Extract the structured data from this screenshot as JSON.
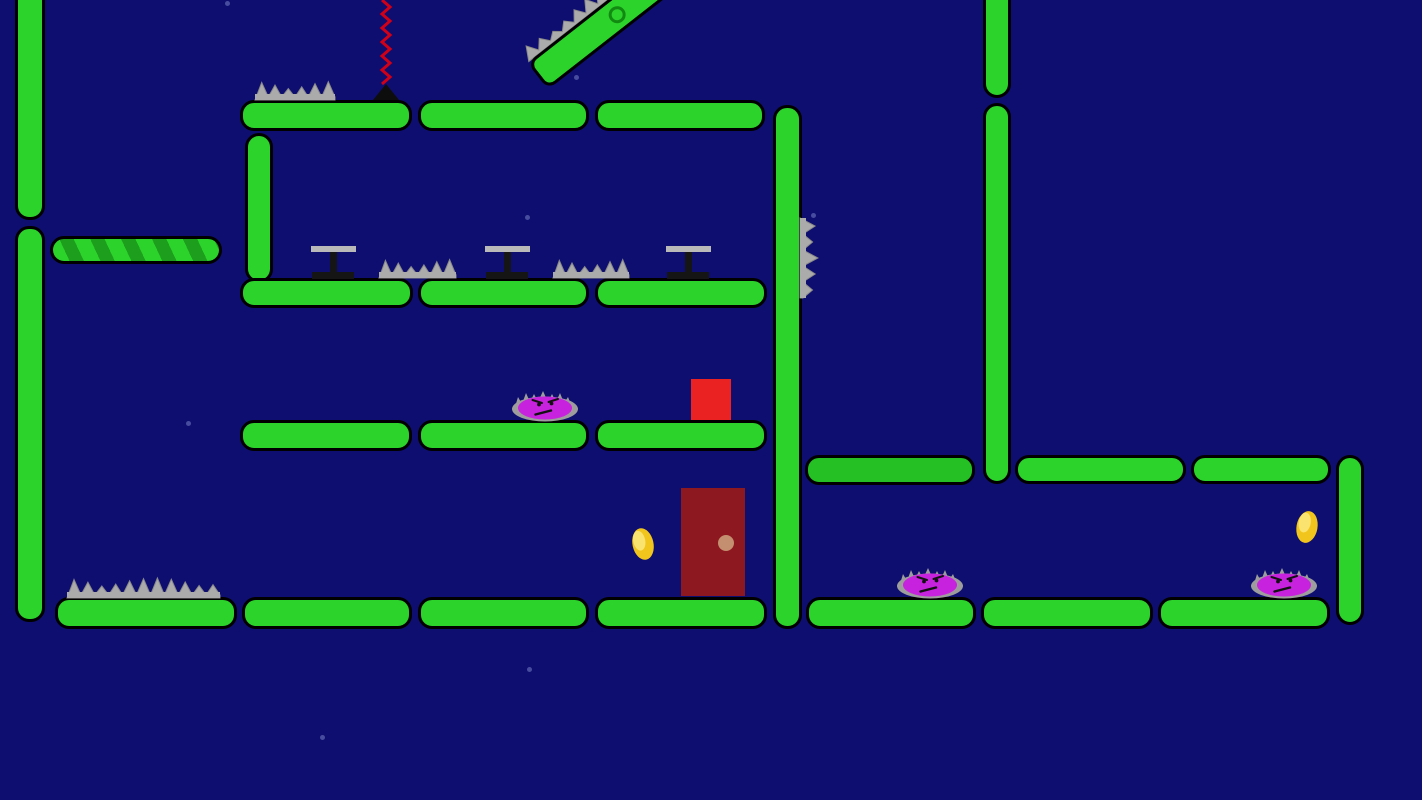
{
  "scene": {
    "width": 1422,
    "height": 800,
    "description": "2D platformer level: night-blue sky, green capsule platforms, gray spikes, purple spiky enemies, gold coins, maroon exit door, red player block, striped and mossy platforms, red zigzag rope, tilted spiked platform with pivot pin"
  },
  "colors": {
    "background": "#0e0e70",
    "platform_green": "#2bd32b",
    "platform_outline": "#000000",
    "stripe_dark": "#1d9e1d",
    "moss_green": "#24c024",
    "spike_gray": "#ababab",
    "spike_edge": "#8a8a8a",
    "table_gray": "#b9b9b9",
    "table_dark": "#151515",
    "enemy_purple": "#c722dd",
    "enemy_aura": "#9d9d9d",
    "enemy_face": "#111111",
    "coin_gold": "#f2c51d",
    "coin_highlight": "#fbe87c",
    "door_red": "#8e1820",
    "door_knob": "#c38f70",
    "player_red": "#ea2222",
    "rope_red": "#cf0018",
    "anchor_black": "#0d0d0d",
    "pin_green": "#128a12",
    "star": "#8e9ad8"
  },
  "platforms": [
    {
      "x": 15,
      "y": -14,
      "w": 30,
      "h": 234,
      "kind": "pillar"
    },
    {
      "x": 15,
      "y": 226,
      "w": 30,
      "h": 396,
      "kind": "pillar"
    },
    {
      "x": 245,
      "y": 133,
      "w": 28,
      "h": 150,
      "kind": "pillar"
    },
    {
      "x": 773,
      "y": 105,
      "w": 29,
      "h": 524,
      "kind": "pillar"
    },
    {
      "x": 983,
      "y": -14,
      "w": 28,
      "h": 112,
      "kind": "pillar"
    },
    {
      "x": 983,
      "y": 103,
      "w": 28,
      "h": 381,
      "kind": "pillar"
    },
    {
      "x": 1336,
      "y": 455,
      "w": 28,
      "h": 170,
      "kind": "pillar"
    },
    {
      "x": 240,
      "y": 100,
      "w": 172,
      "h": 31,
      "kind": "normal"
    },
    {
      "x": 418,
      "y": 100,
      "w": 171,
      "h": 31,
      "kind": "normal"
    },
    {
      "x": 595,
      "y": 100,
      "w": 170,
      "h": 31,
      "kind": "normal"
    },
    {
      "x": 240,
      "y": 278,
      "w": 173,
      "h": 30,
      "kind": "normal"
    },
    {
      "x": 418,
      "y": 278,
      "w": 171,
      "h": 30,
      "kind": "normal"
    },
    {
      "x": 595,
      "y": 278,
      "w": 172,
      "h": 30,
      "kind": "normal"
    },
    {
      "x": 240,
      "y": 420,
      "w": 172,
      "h": 31,
      "kind": "normal"
    },
    {
      "x": 418,
      "y": 420,
      "w": 171,
      "h": 31,
      "kind": "normal"
    },
    {
      "x": 595,
      "y": 420,
      "w": 172,
      "h": 31,
      "kind": "normal"
    },
    {
      "x": 55,
      "y": 597,
      "w": 182,
      "h": 32,
      "kind": "normal"
    },
    {
      "x": 242,
      "y": 597,
      "w": 170,
      "h": 32,
      "kind": "normal"
    },
    {
      "x": 418,
      "y": 597,
      "w": 171,
      "h": 32,
      "kind": "normal"
    },
    {
      "x": 595,
      "y": 597,
      "w": 172,
      "h": 32,
      "kind": "normal"
    },
    {
      "x": 806,
      "y": 597,
      "w": 170,
      "h": 32,
      "kind": "normal"
    },
    {
      "x": 981,
      "y": 597,
      "w": 172,
      "h": 32,
      "kind": "normal"
    },
    {
      "x": 1158,
      "y": 597,
      "w": 172,
      "h": 32,
      "kind": "normal"
    },
    {
      "x": 1015,
      "y": 455,
      "w": 171,
      "h": 29,
      "kind": "normal"
    },
    {
      "x": 1191,
      "y": 455,
      "w": 140,
      "h": 29,
      "kind": "normal"
    },
    {
      "x": 50,
      "y": 236,
      "w": 172,
      "h": 28,
      "kind": "striped"
    },
    {
      "x": 805,
      "y": 455,
      "w": 170,
      "h": 30,
      "kind": "moss"
    }
  ],
  "tilted_platform": {
    "cx": 607,
    "cy": 22,
    "length": 176,
    "thickness": 34,
    "angle_deg": -38,
    "pin_offset_px": 92,
    "spike_span_px": 105
  },
  "rope": {
    "x": 386,
    "y_top": 0,
    "y_bottom": 84,
    "amplitude": 4,
    "step": 7
  },
  "rope_anchor": {
    "cx": 386,
    "base_y": 100,
    "w": 26,
    "h": 16
  },
  "spike_clusters": [
    {
      "x": 255,
      "y": 81,
      "w": 80,
      "h": 19,
      "dir": "up",
      "teeth": 6
    },
    {
      "x": 379,
      "y": 259,
      "w": 77,
      "h": 19,
      "dir": "up",
      "teeth": 6
    },
    {
      "x": 553,
      "y": 259,
      "w": 76,
      "h": 19,
      "dir": "up",
      "teeth": 6
    },
    {
      "x": 67,
      "y": 578,
      "w": 153,
      "h": 20,
      "dir": "up",
      "teeth": 11
    },
    {
      "x": 800,
      "y": 218,
      "w": 18,
      "h": 80,
      "dir": "right",
      "teeth": 5
    }
  ],
  "tables": [
    {
      "cx": 333,
      "top_y": 246
    },
    {
      "cx": 507,
      "top_y": 246
    },
    {
      "cx": 688,
      "top_y": 246
    }
  ],
  "table_style": {
    "bar_w": 45,
    "bar_h": 6,
    "stem_w": 7,
    "stem_h": 20,
    "base_w": 42,
    "base_h": 7
  },
  "enemies": [
    {
      "cx": 545,
      "ground_y": 420
    },
    {
      "cx": 930,
      "ground_y": 597
    },
    {
      "cx": 1284,
      "ground_y": 597
    }
  ],
  "coins": [
    {
      "cx": 643,
      "cy": 544,
      "rot": -12
    },
    {
      "cx": 1307,
      "cy": 527,
      "rot": 10
    }
  ],
  "door": {
    "x": 681,
    "y": 488,
    "w": 64,
    "h": 108
  },
  "door_knob": {
    "cx": 726,
    "cy": 543,
    "r": 8
  },
  "player": {
    "x": 691,
    "y": 379,
    "w": 40,
    "h": 41
  },
  "stars": [
    [
      227,
      3
    ],
    [
      576,
      77
    ],
    [
      527,
      217
    ],
    [
      188,
      423
    ],
    [
      529,
      669
    ],
    [
      322,
      737
    ],
    [
      813,
      215
    ]
  ]
}
